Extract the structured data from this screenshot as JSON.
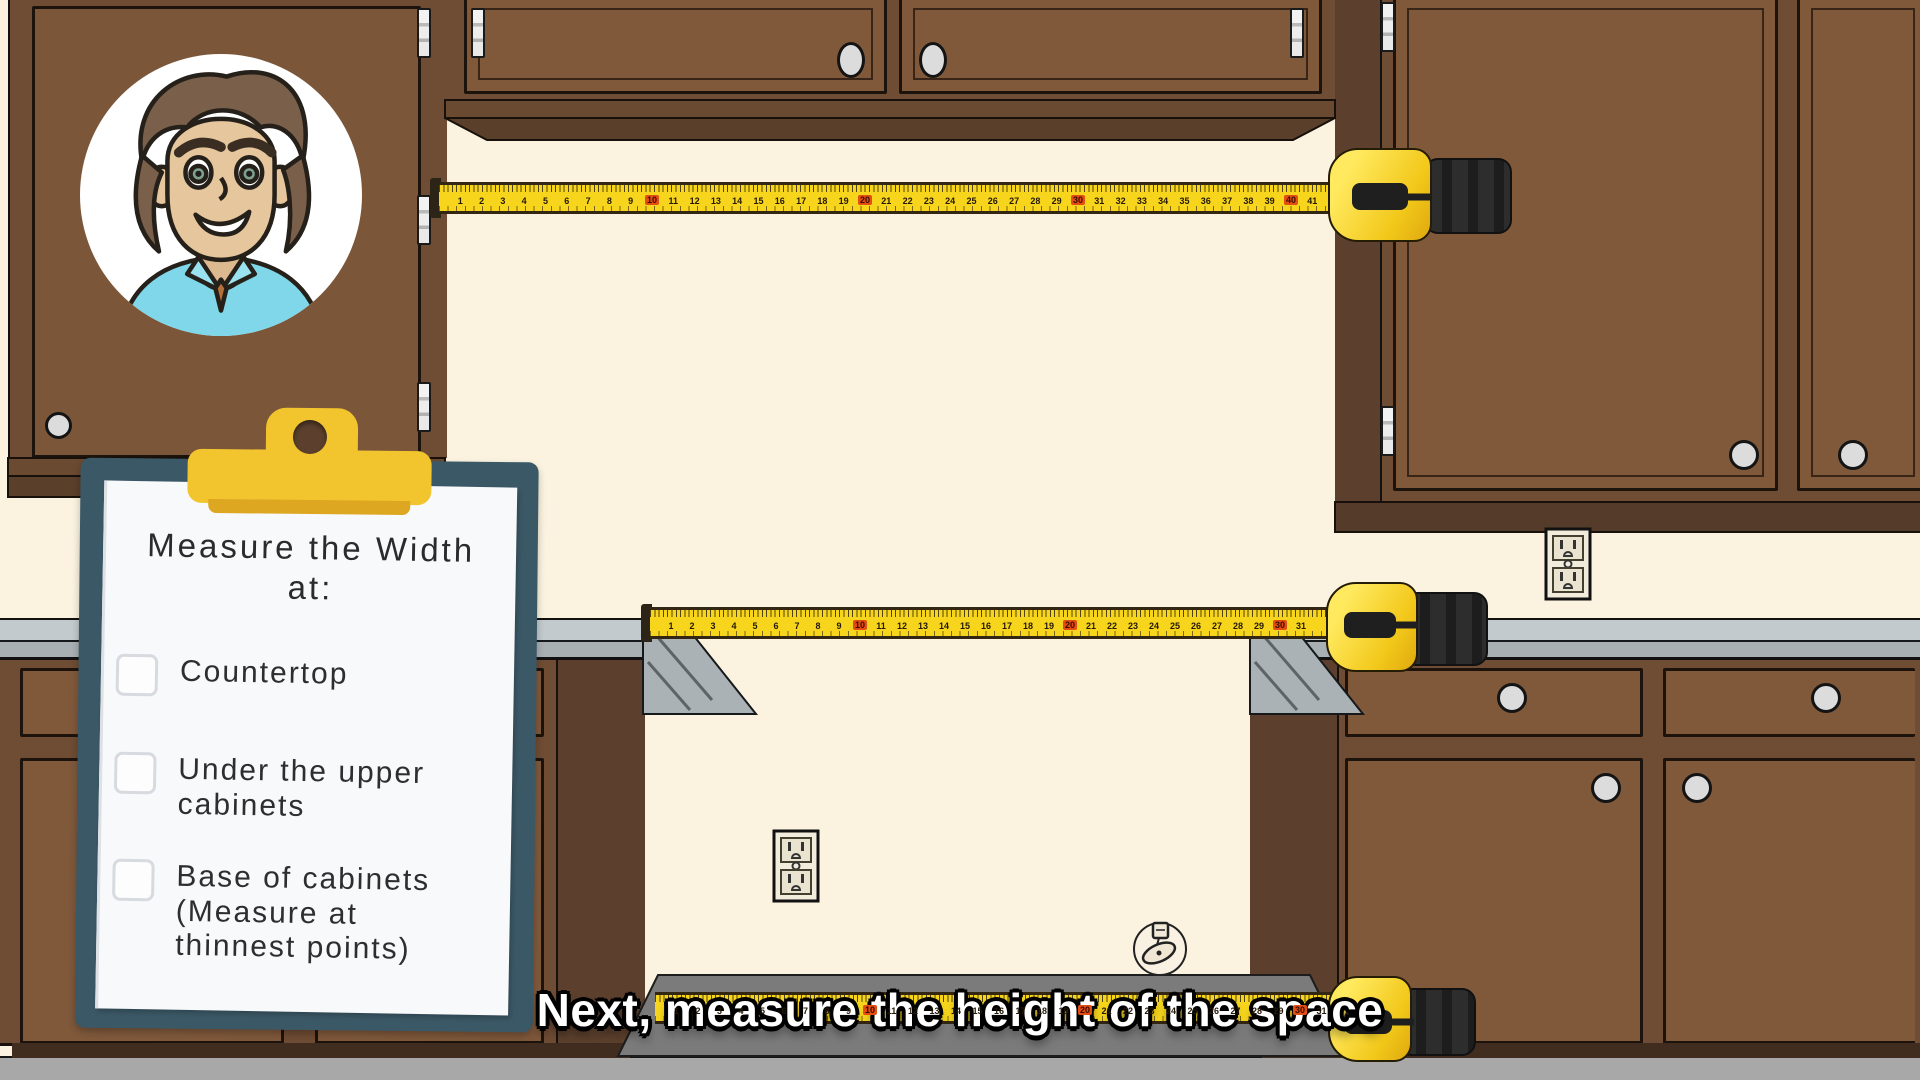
{
  "caption": {
    "text": "Next, measure the height of the space"
  },
  "clipboard": {
    "title_line1": "Measure the Width",
    "title_line2": "at:",
    "items": [
      {
        "label": "Countertop",
        "checked": false
      },
      {
        "label": "Under the upper cabinets",
        "checked": false
      },
      {
        "label": "Base of cabinets (Measure at thinnest points)",
        "checked": false
      }
    ]
  },
  "tapes": {
    "top": {
      "unit_count": 41,
      "unit_spacing": 21.3,
      "red_every": 10
    },
    "countertop": {
      "unit_count": 31,
      "unit_spacing": 21.0,
      "red_every": 10
    },
    "floor": {
      "unit_count": 31,
      "unit_spacing": 21.5,
      "red_every": 10
    }
  },
  "colors": {
    "wall": "#fbf3e0",
    "floor": "#a8a8a8",
    "toe_recess": "#7b7b7b",
    "cabinet_face": "#80593b",
    "cabinet_frame": "#6f4c34",
    "cabinet_side": "#5c402d",
    "cabinet_trim": "#5a3f2b",
    "countertop_top": "#c3cacd",
    "countertop_edge": "#a9b0b4",
    "tape_yellow": "#f6d51c",
    "tape_red_marker": "#e44d12",
    "clipboard_board": "#3b5866",
    "clip_yellow": "#f2c42d",
    "paper": "#f8f9fb",
    "caption_text": "#ffffff",
    "caption_outline": "#000000",
    "avatar_shirt": "#7fd7e9",
    "avatar_hair": "#7a604a",
    "avatar_skin": "#e6c69c"
  },
  "icons": {
    "checkbox": "empty-checkbox",
    "outlet": "power-outlet",
    "floor_fixture": "floor-gas-connector",
    "clip": "clipboard-clip",
    "hinge": "cabinet-hinge",
    "knob": "cabinet-knob"
  }
}
